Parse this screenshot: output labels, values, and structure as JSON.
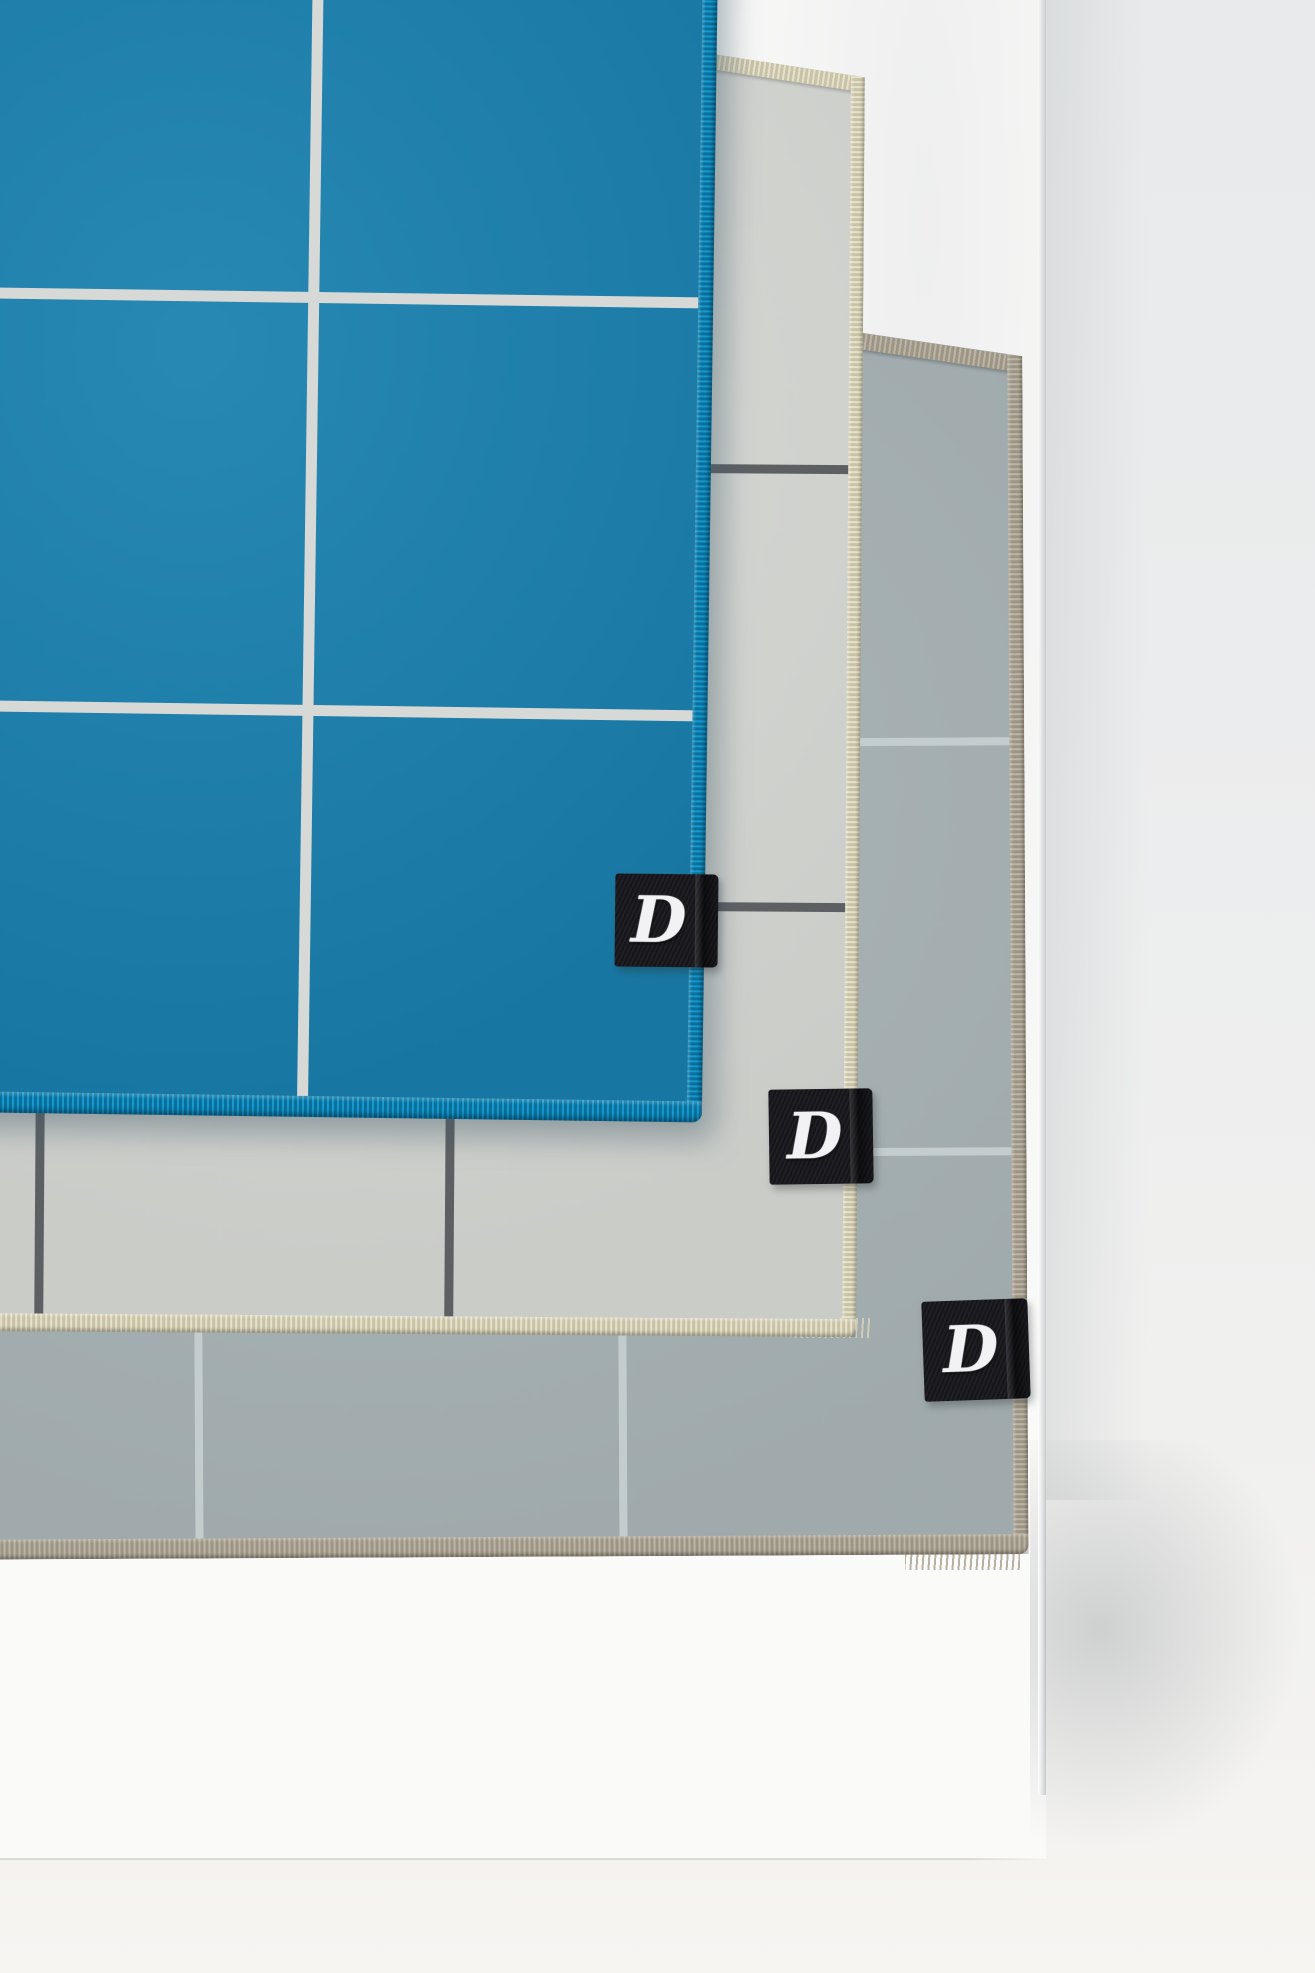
{
  "scene": {
    "type": "product-photograph",
    "subject": "Three layered grid-pattern fleece mats draped over a white display board against a light wall",
    "layers": [
      {
        "name": "teal blue mat with white grid",
        "position": "top"
      },
      {
        "name": "light gray mat with dark gray grid",
        "position": "middle"
      },
      {
        "name": "gray-blue mat with light gray grid",
        "position": "bottom"
      }
    ]
  },
  "tags": [
    {
      "label": "D"
    },
    {
      "label": "D"
    },
    {
      "label": "D"
    }
  ],
  "colors": {
    "mat1_fabric": "#1a81af",
    "mat1_grid": "#d6d9d6",
    "mat1_stitch": "#0e84b4",
    "mat2_fabric": "#d5d7d3",
    "mat2_grid": "#5d6063",
    "mat2_stitch": "#e0dbc4",
    "mat3_fabric": "#a8b3b5",
    "mat3_grid": "#c4cdce",
    "mat3_stitch": "#b4ac9f",
    "tag_fabric": "#16161a",
    "tag_logo": "#f2f2f5",
    "board": "#fafaf9",
    "wall": "#ebeced",
    "floor": "#f4f3f0"
  }
}
